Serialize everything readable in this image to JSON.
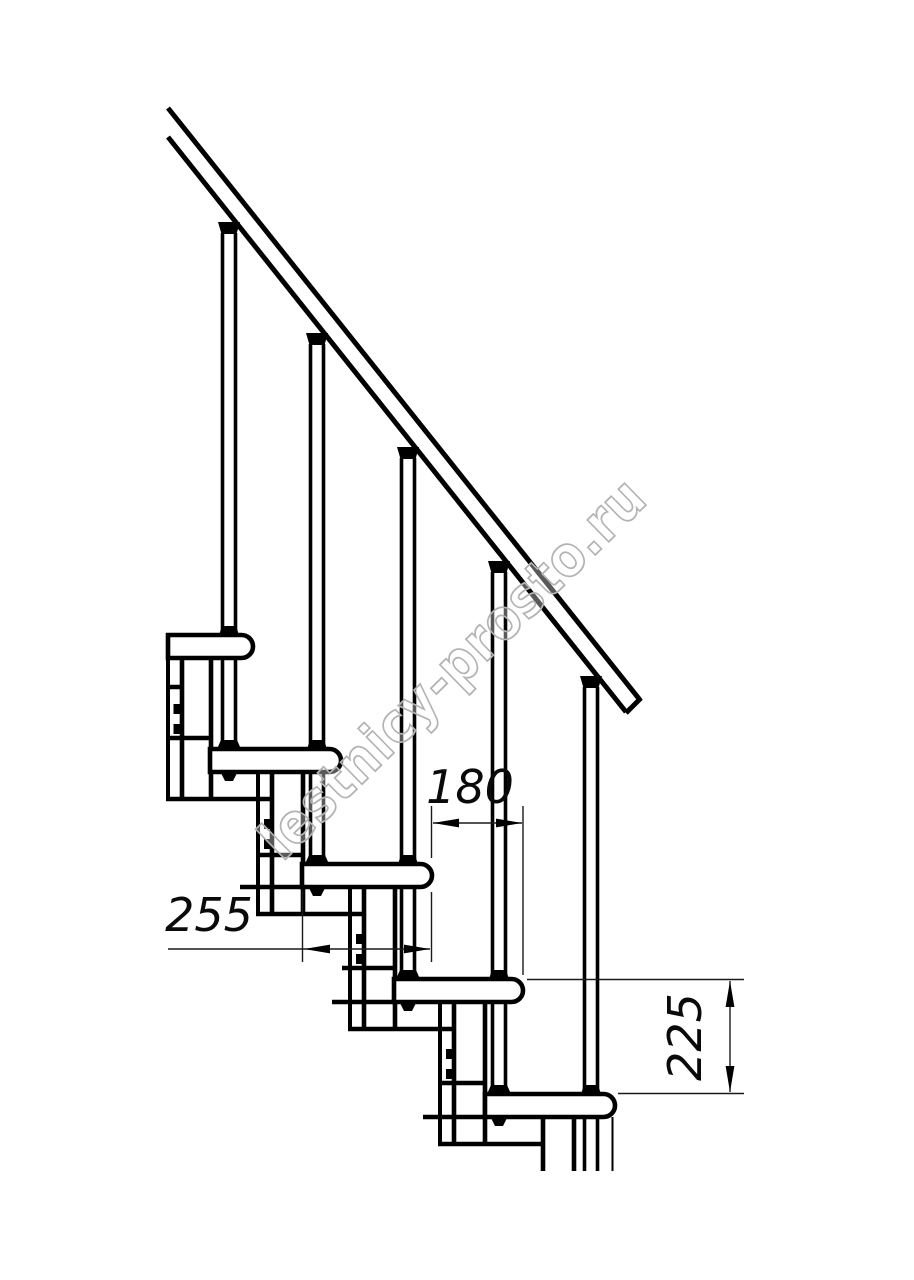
{
  "page": {
    "background": "#ffffff",
    "line_color": "#000000"
  },
  "watermark": {
    "text": "lestnicy-prosto.ru",
    "color": "#b3b3b3"
  },
  "dimensions": {
    "step_run": {
      "label": "180"
    },
    "tread_depth": {
      "label": "255"
    },
    "step_rise": {
      "label": "225"
    }
  },
  "drawing": {
    "type": "modular-staircase-side-elevation",
    "treads_visible": 5,
    "balusters_visible": 5
  }
}
